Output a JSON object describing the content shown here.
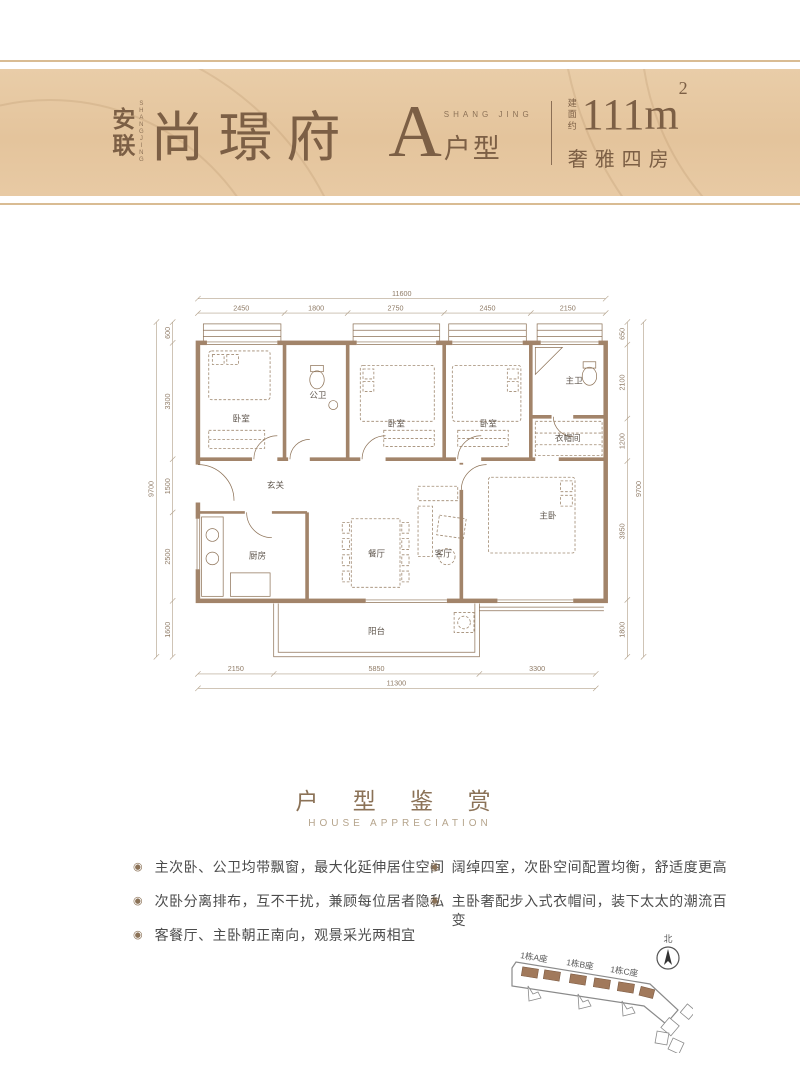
{
  "banner": {
    "brand_cn_1": "安",
    "brand_cn_2": "联",
    "brand_en_vertical": "SHANGJING",
    "project_name": "尚璟府",
    "unit_letter": "A",
    "unit_en": "SHANG JING",
    "unit_label": "户型",
    "area_prefix_1": "建",
    "area_prefix_2": "面",
    "area_prefix_3": "约",
    "area_value": "111m",
    "area_sup": "2",
    "tagline": "奢雅四房"
  },
  "floorplan": {
    "rooms": {
      "bedroom1": "卧室",
      "public_bath": "公卫",
      "bedroom2": "卧室",
      "bedroom3": "卧室",
      "master_bath": "主卫",
      "cloakroom": "衣帽间",
      "foyer": "玄关",
      "kitchen": "厨房",
      "dining": "餐厅",
      "living": "客厅",
      "master_bedroom": "主卧",
      "balcony": "阳台"
    },
    "dims_top": {
      "overall": "11600",
      "segments": [
        "2450",
        "1800",
        "2750",
        "2450",
        "2150"
      ]
    },
    "dims_bottom": {
      "overall": "11300",
      "segments": [
        "2150",
        "5850",
        "3300"
      ]
    },
    "dims_left": {
      "overall": "9700",
      "segments": [
        "600",
        "3300",
        "1500",
        "2500",
        "1600"
      ]
    },
    "dims_right": {
      "overall": "9700",
      "segments": [
        "650",
        "2100",
        "1200",
        "3950",
        "1800"
      ]
    }
  },
  "section": {
    "title_cn": "户 型 鉴 赏",
    "title_en": "HOUSE APPRECIATION",
    "bullets_left": [
      "主次卧、公卫均带飘窗，最大化延伸居住空间",
      "次卧分离排布，互不干扰，兼顾每位居者隐私",
      "客餐厅、主卧朝正南向，观景采光两相宜"
    ],
    "bullets_right": [
      "阔绰四室，次卧空间配置均衡，舒适度更高",
      "主卧奢配步入式衣帽间，装下太太的潮流百变"
    ],
    "bullet_icon": "◉"
  },
  "siteplan": {
    "labels": [
      "1栋A座",
      "1栋B座",
      "1栋C座"
    ],
    "north_label": "北"
  },
  "colors": {
    "banner_bg": "#e6c8a2",
    "banner_text": "#7c5f45",
    "wall_brown": "#a2846a",
    "accent_brown": "#8b7257"
  }
}
